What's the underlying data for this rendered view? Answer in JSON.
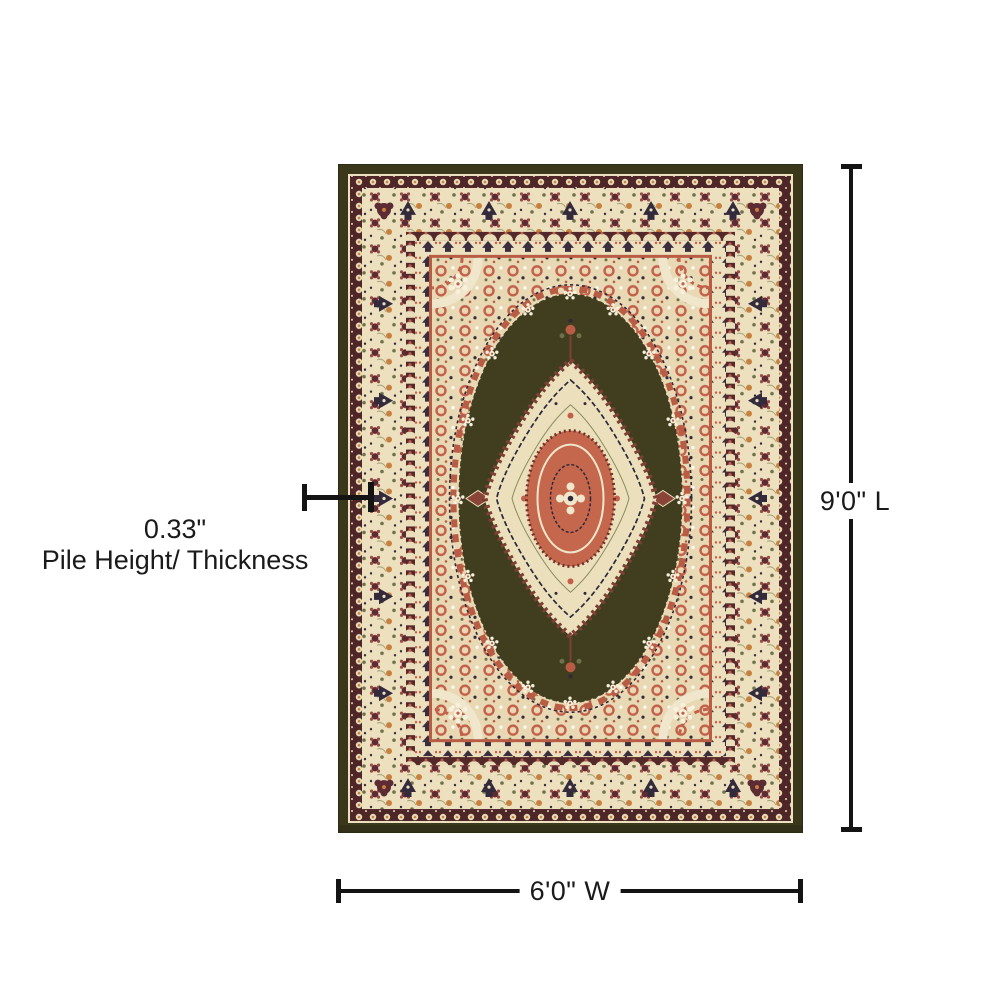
{
  "diagram": {
    "length_label": "9'0\" L",
    "width_label": "6'0\" W",
    "pile_height": {
      "value": "0.33\"",
      "label": "Pile Height/ Thickness"
    },
    "line_color": "#141414",
    "background": "#ffffff"
  },
  "rug": {
    "name": "traditional-medallion-area-rug",
    "colors": {
      "field_olive": "#413d1f",
      "outer_band_olive": "#3b371b",
      "border_cream": "#ece0bf",
      "guard_maroon": "#4f2628",
      "accent_salmon": "#c2604a",
      "medallion_red": "#c4674c",
      "detail_navy": "#33283a",
      "accent_orange": "#c8803f",
      "leaf_green": "#6d7049",
      "sprig_white": "#f6f0dd"
    }
  }
}
